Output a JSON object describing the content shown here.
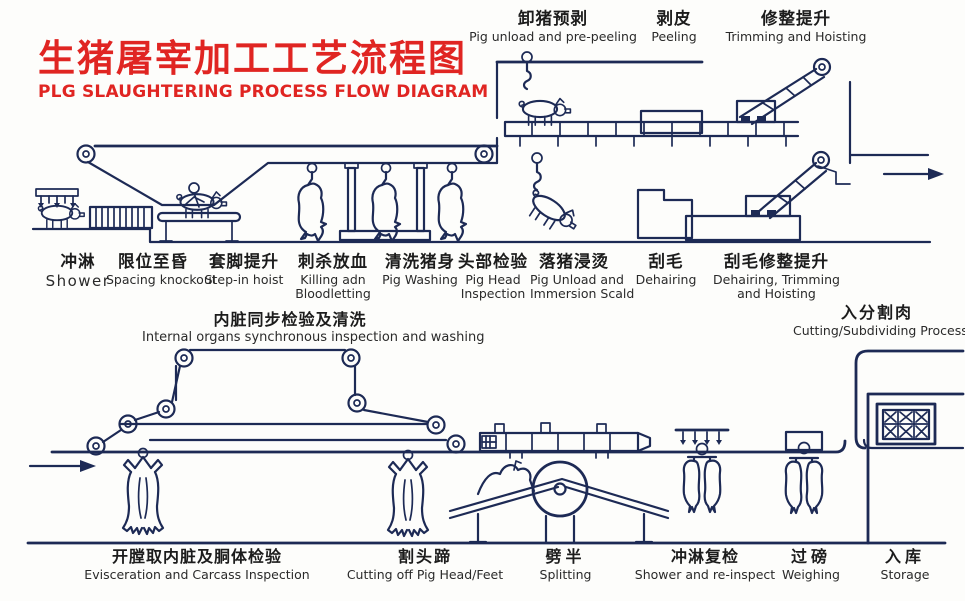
{
  "title": {
    "zh": "生猪屠宰加工工艺流程图",
    "en": "PLG SLAUGHTERING PROCESS FLOW DIAGRAM"
  },
  "colors": {
    "accent_red": "#e02522",
    "line_ink": "#1d2a55",
    "text": "#1c1c1c",
    "background": "#fdfdfb"
  },
  "top_stages": [
    {
      "zh": "卸猪预剥",
      "en": "Pig unload and pre-peeling"
    },
    {
      "zh": "剥皮",
      "en": "Peeling"
    },
    {
      "zh": "修整提升",
      "en": "Trimming and Hoisting"
    }
  ],
  "mid_stages": [
    {
      "zh": "冲淋",
      "en": "Shower",
      "en2": ""
    },
    {
      "zh": "限位至昏",
      "en": "Spacing knockout",
      "en2": ""
    },
    {
      "zh": "套脚提升",
      "en": "Step-in hoist",
      "en2": ""
    },
    {
      "zh": "刺杀放血",
      "en": "Killing adn",
      "en2": "Bloodletting"
    },
    {
      "zh": "清洗猪身",
      "en": "Pig Washing",
      "en2": ""
    },
    {
      "zh": "头部检验",
      "en": "Pig Head",
      "en2": "Inspection"
    },
    {
      "zh": "落猪浸烫",
      "en": "Pig Unload and",
      "en2": "Immersion Scald"
    },
    {
      "zh": "刮毛",
      "en": "Dehairing",
      "en2": ""
    },
    {
      "zh": "刮毛修整提升",
      "en": "Dehairing, Trimming",
      "en2": "and Hoisting"
    }
  ],
  "aux_stages": [
    {
      "zh": "内脏同步检验及清洗",
      "en": "Internal organs synchronous inspection and washing"
    },
    {
      "zh": "入分割肉",
      "en": "Cutting/Subdividing Process"
    }
  ],
  "bottom_stages": [
    {
      "zh": "开膛取内脏及胴体检验",
      "en": "Evisceration and Carcass Inspection"
    },
    {
      "zh": "割头蹄",
      "en": "Cutting off Pig Head/Feet"
    },
    {
      "zh": "劈半",
      "en": "Splitting"
    },
    {
      "zh": "冲淋复检",
      "en": "Shower and re-inspect"
    },
    {
      "zh": "过磅",
      "en": "Weighing"
    },
    {
      "zh": "入库",
      "en": "Storage"
    }
  ]
}
